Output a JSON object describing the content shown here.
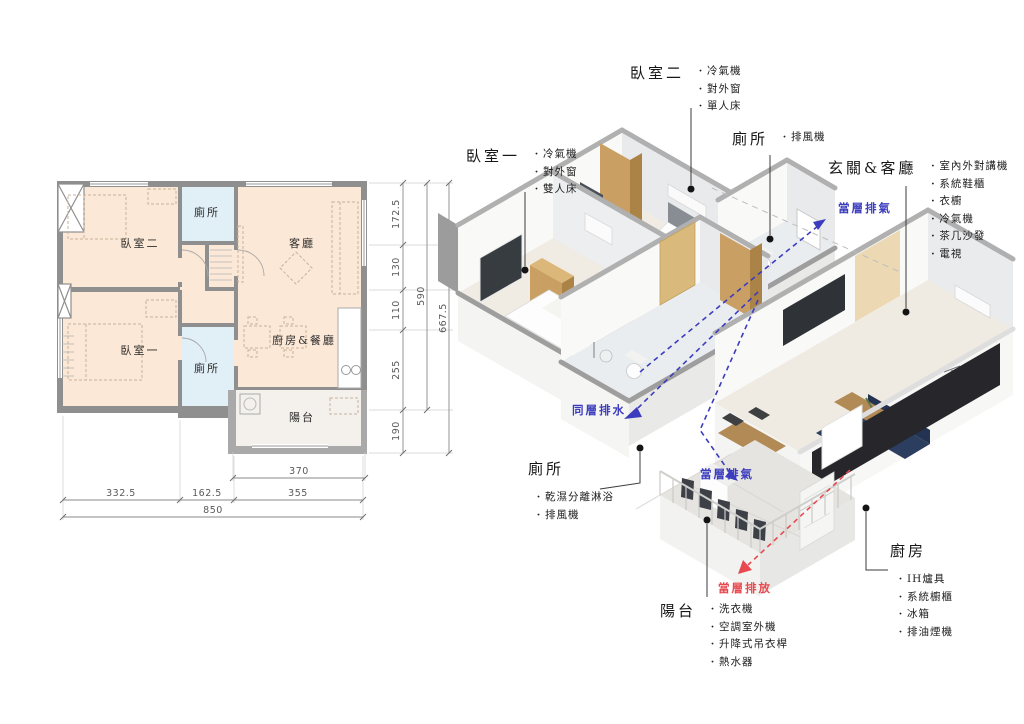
{
  "plan": {
    "rooms": {
      "bedroom2": "臥室二",
      "toilet_top": "廁所",
      "living": "客廳",
      "bedroom1": "臥室一",
      "toilet_bottom": "廁所",
      "kitchen_dining": "廚房&餐廳",
      "balcony": "陽台"
    },
    "dims": {
      "v1": "172.5",
      "v2": "130",
      "v3": "110",
      "v4": "255",
      "v5": "190",
      "vt1": "590",
      "vt2": "667.5",
      "h1": "370",
      "h2": "332.5",
      "h3": "162.5",
      "h4": "355",
      "ht": "850"
    }
  },
  "iso": {
    "annotations": [
      {
        "id": "bedroom1",
        "title": "臥室一",
        "items": [
          "冷氣機",
          "對外窗",
          "雙人床"
        ]
      },
      {
        "id": "bedroom2",
        "title": "臥室二",
        "items": [
          "冷氣機",
          "對外窗",
          "單人床"
        ]
      },
      {
        "id": "toilet_top",
        "title": "廁所",
        "items": [
          "排風機"
        ]
      },
      {
        "id": "entry_living",
        "title": "玄關&客廳",
        "items": [
          "室內外對講機",
          "系統鞋櫃",
          "衣櫥",
          "冷氣機",
          "茶几沙發",
          "電視"
        ]
      },
      {
        "id": "toilet_left",
        "title": "廁所",
        "items": [
          "乾濕分離淋浴",
          "排風機"
        ]
      },
      {
        "id": "balcony",
        "title": "陽台",
        "items": [
          "洗衣機",
          "空調室外機",
          "升降式吊衣桿",
          "熱水器"
        ]
      },
      {
        "id": "kitchen",
        "title": "廚房",
        "items": [
          "IH爐具",
          "系統櫥櫃",
          "冰箱",
          "排油煙機"
        ]
      }
    ],
    "flows": {
      "exhaust_top": "當層排氣",
      "exhaust_bottom": "當層排氣",
      "drain": "同層排水",
      "discharge": "當層排放"
    }
  },
  "colors": {
    "room_peach": "#fce8d6",
    "toilet_blue": "#e1eff7",
    "wall_gray": "#8f8f8f",
    "flow_blue": "#3c3cbe",
    "flow_red": "#e8494f"
  }
}
